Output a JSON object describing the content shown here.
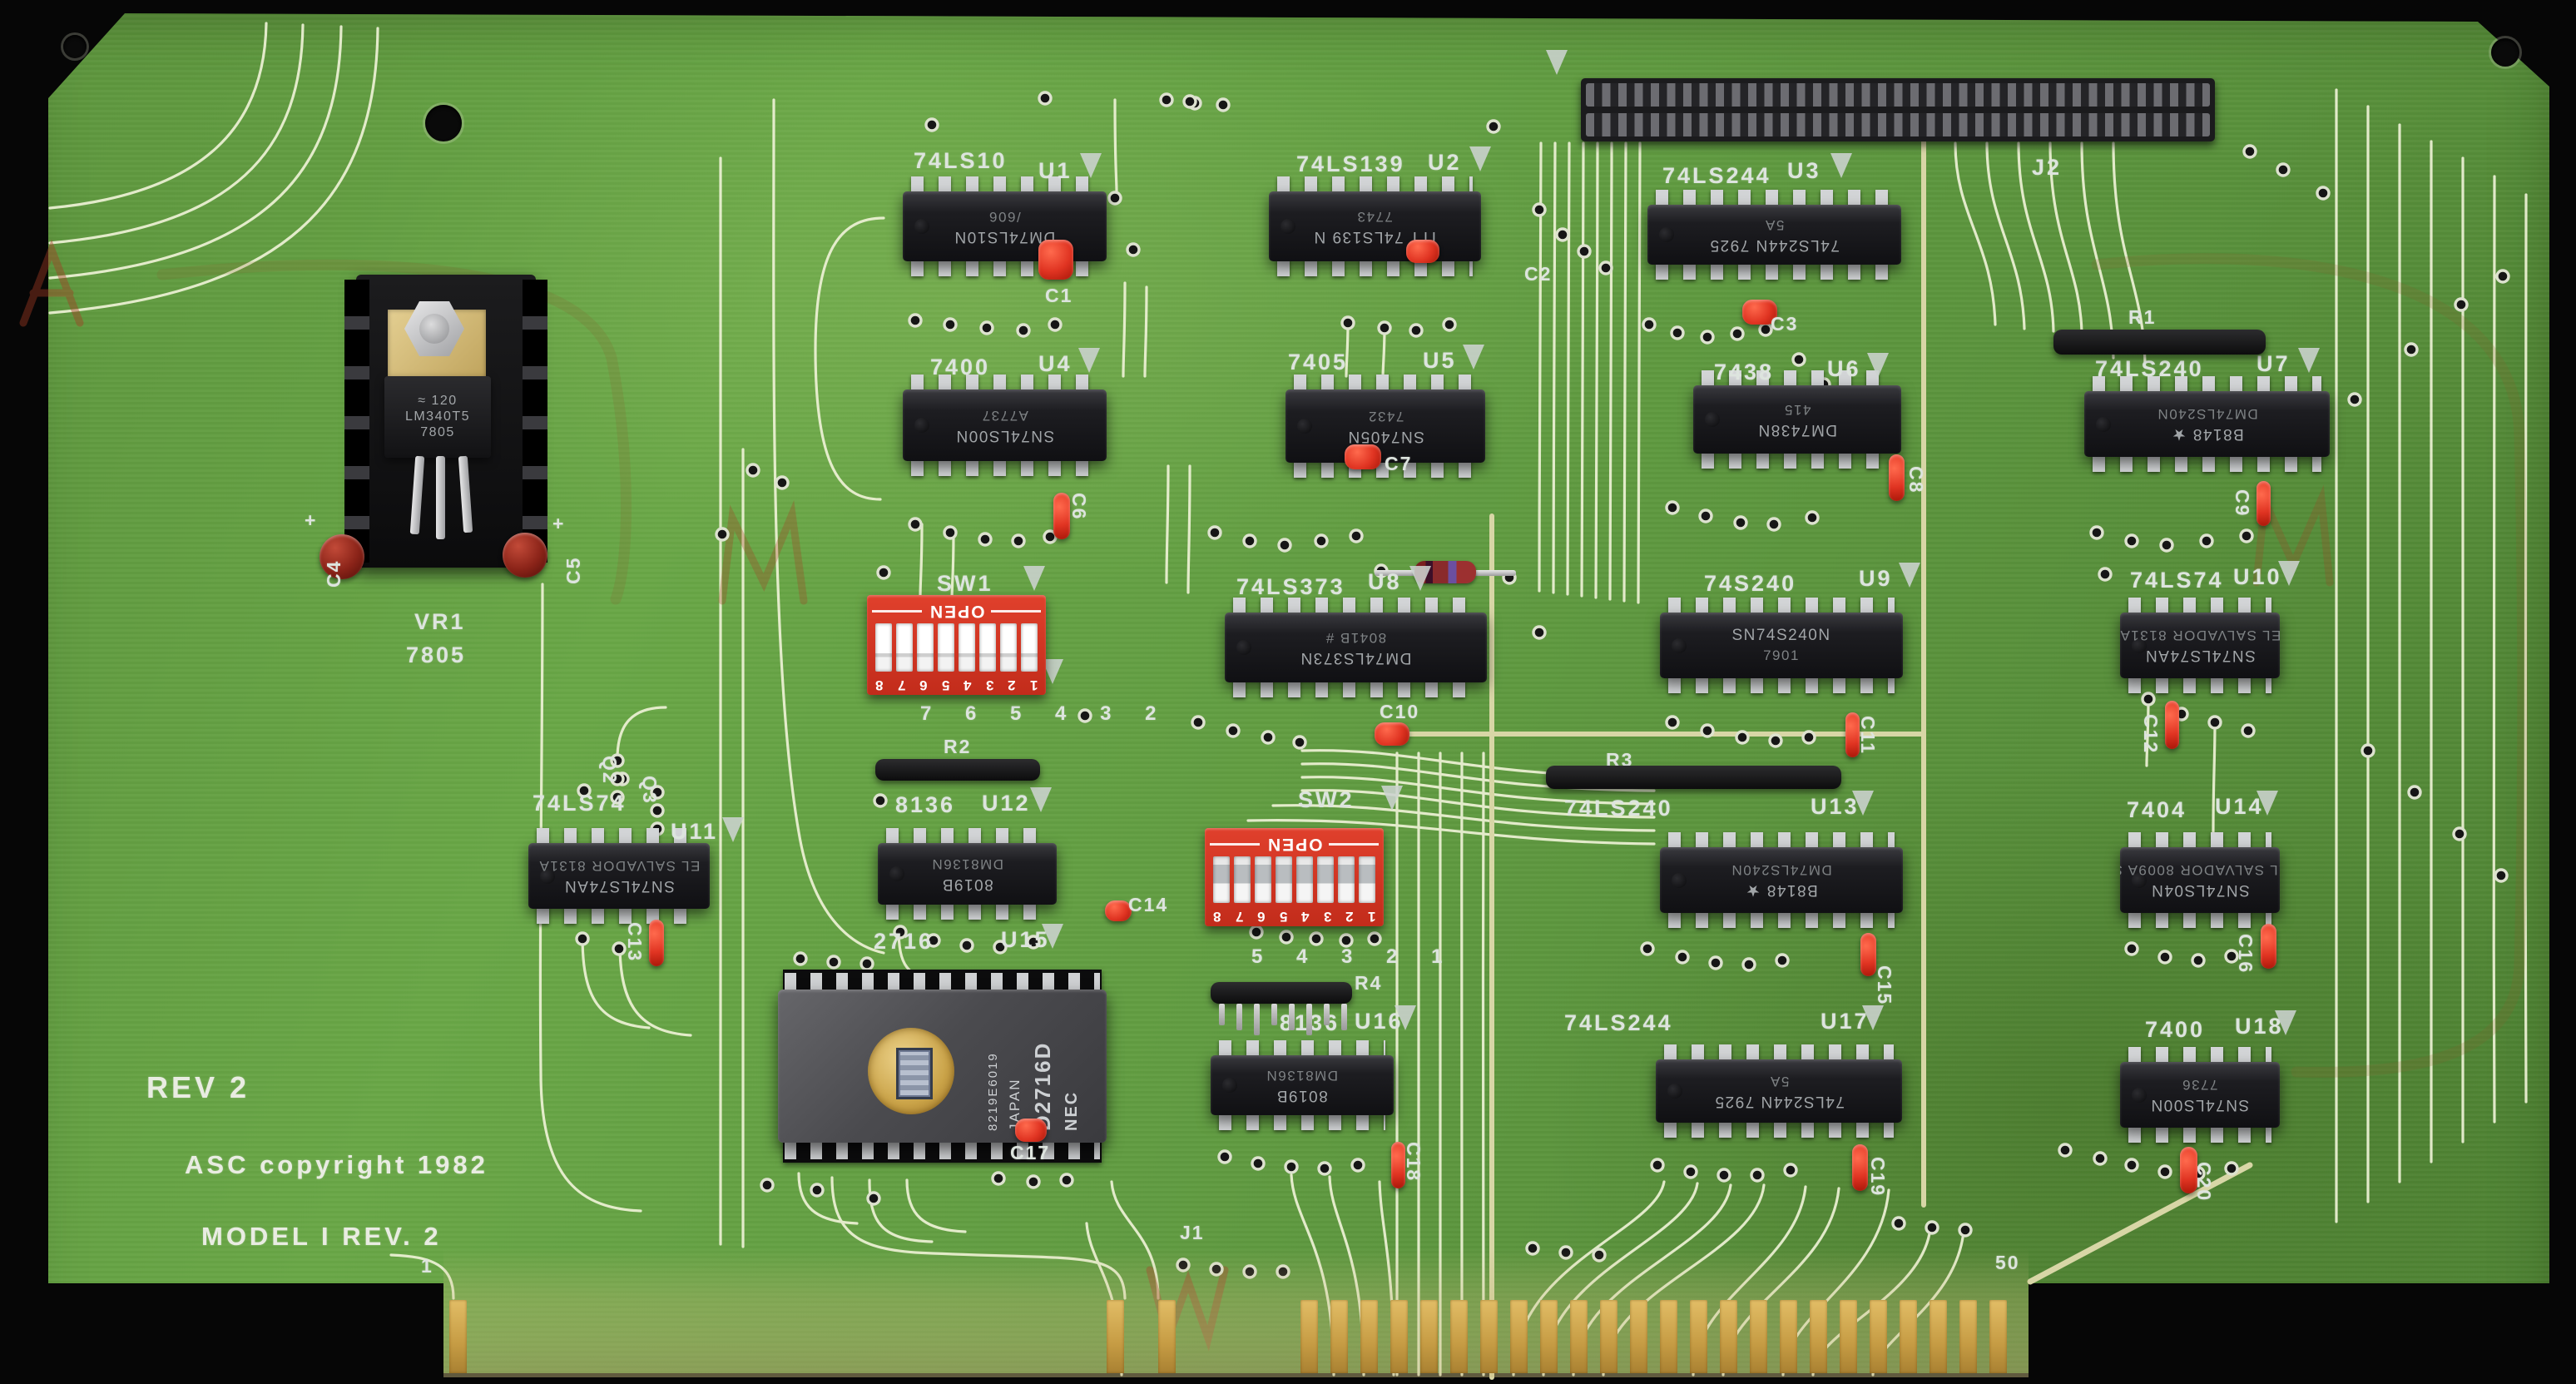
{
  "board": {
    "rev_text": "REV 2",
    "copyright_text": "ASC copyright 1982",
    "model_text": "MODEL I REV. 2",
    "edge": {
      "label": "J1",
      "first_pin": "1",
      "last_pin": "50"
    }
  },
  "colors": {
    "board_green": "#5f9a40",
    "silkscreen": "#dde4de",
    "switch_red": "#d23520",
    "gold": "#c69c44"
  },
  "components": {
    "j2": {
      "ref": "J2"
    },
    "vr1": {
      "ref": "VR1",
      "value": "7805",
      "marking": [
        "≈ 120",
        "LM340T5",
        "7805"
      ]
    },
    "q2": {
      "ref": "Q2"
    },
    "q3": {
      "ref": "Q3"
    },
    "r1": {
      "ref": "R1"
    },
    "r2": {
      "ref": "R2"
    },
    "r3": {
      "ref": "R3"
    },
    "r4": {
      "ref": "R4"
    },
    "sw1": {
      "ref": "SW1",
      "open": "OPEN",
      "positions": [
        "1",
        "2",
        "3",
        "4",
        "5",
        "6",
        "7",
        "8"
      ],
      "silk_numbers": "7 6 5 4 3 2"
    },
    "sw2": {
      "ref": "SW2",
      "open": "OPEN",
      "positions": [
        "1",
        "2",
        "3",
        "4",
        "5",
        "6",
        "7",
        "8"
      ],
      "silk_numbers": "5 4 3 2 1"
    },
    "u1": {
      "ref": "U1",
      "silk": "74LS10",
      "marking": [
        "DM74LS10N",
        "/606"
      ]
    },
    "u2": {
      "ref": "U2",
      "silk": "74LS139",
      "marking": [
        "ITT 74LS139 N",
        "7743"
      ]
    },
    "u3": {
      "ref": "U3",
      "silk": "74LS244",
      "marking": [
        "74LS244N 7925",
        "5A"
      ]
    },
    "u4": {
      "ref": "U4",
      "silk": "7400",
      "marking": [
        "SN74LS00N",
        "A7737"
      ]
    },
    "u5": {
      "ref": "U5",
      "silk": "7405",
      "marking": [
        "SN7405N",
        "7432"
      ]
    },
    "u6": {
      "ref": "U6",
      "silk": "7438",
      "marking": [
        "DM7438N",
        "415"
      ]
    },
    "u7": {
      "ref": "U7",
      "silk": "74LS240",
      "marking": [
        "B8148 ★",
        "DM74LS240N"
      ]
    },
    "u8": {
      "ref": "U8",
      "silk": "74LS373",
      "marking": [
        "DM74LS373N",
        "8041B #"
      ]
    },
    "u9": {
      "ref": "U9",
      "silk": "74S240",
      "marking": [
        "SN74S240N",
        "7901"
      ]
    },
    "u10": {
      "ref": "U10",
      "silk": "74LS74",
      "marking": [
        "SN74LS74AN",
        "EL SALVADOR 8131A"
      ]
    },
    "u11": {
      "ref": "U11",
      "silk": "74LS74",
      "marking": [
        "SN74LS74AN",
        "EL SALVADOR 8131A"
      ]
    },
    "u12": {
      "ref": "U12",
      "silk": "8136",
      "marking": [
        "8019B",
        "DM8136N"
      ]
    },
    "u13": {
      "ref": "U13",
      "silk": "74LS240",
      "marking": [
        "B8148 ★",
        "DM74LS240N"
      ]
    },
    "u14": {
      "ref": "U14",
      "silk": "7404",
      "marking": [
        "SN74LS04N",
        "EL SALVADOR 8009A S"
      ]
    },
    "u15": {
      "ref": "U15",
      "silk": "2716",
      "marking": [
        "NEC",
        "D2716D",
        "JAPAN",
        "8219E6019"
      ]
    },
    "u16": {
      "ref": "U16",
      "silk": "8136",
      "marking": [
        "8019B",
        "DM8136N"
      ]
    },
    "u17": {
      "ref": "U17",
      "silk": "74LS244",
      "marking": [
        "74LS244N 7925",
        "5A"
      ]
    },
    "u18": {
      "ref": "U18",
      "silk": "7400",
      "marking": [
        "SN74LS00N",
        "7736"
      ]
    },
    "caps": {
      "c1": {
        "ref": "C1"
      },
      "c2": {
        "ref": "C2"
      },
      "c3": {
        "ref": "C3"
      },
      "c4": {
        "ref": "C4",
        "plus": "+"
      },
      "c5": {
        "ref": "C5",
        "plus": "+"
      },
      "c6": {
        "ref": "C6"
      },
      "c7": {
        "ref": "C7"
      },
      "c8": {
        "ref": "C8"
      },
      "c9": {
        "ref": "C9"
      },
      "c10": {
        "ref": "C10"
      },
      "c11": {
        "ref": "C11"
      },
      "c12": {
        "ref": "C12"
      },
      "c13": {
        "ref": "C13"
      },
      "c14": {
        "ref": "C14"
      },
      "c15": {
        "ref": "C15"
      },
      "c16": {
        "ref": "C16"
      },
      "c17": {
        "ref": "C17"
      },
      "c18": {
        "ref": "C18"
      },
      "c19": {
        "ref": "C19"
      },
      "c20": {
        "ref": "C20"
      }
    }
  }
}
